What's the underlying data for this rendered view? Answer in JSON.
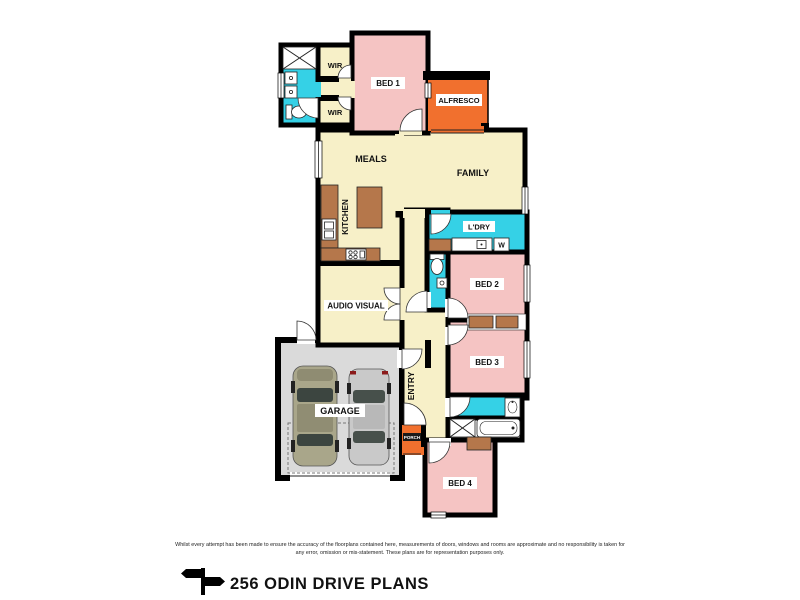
{
  "title": "256 ODIN DRIVE PLANS",
  "disclaimer": {
    "line1": "Whilst every attempt has been made to ensure the accuracy of the floorplans contained here, measurements of doors, windows and rooms are approximate and no responsibility is taken for",
    "line2": "any error, omission or mis-statement. These plans are for representation purposes only."
  },
  "rooms": {
    "bed1": "BED 1",
    "bed2": "BED 2",
    "bed3": "BED 3",
    "bed4": "BED 4",
    "wir1": "WIR",
    "wir2": "WIR",
    "alfresco": "ALFRESCO",
    "meals": "MEALS",
    "family": "FAMILY",
    "kitchen": "KITCHEN",
    "laundry": "L'DRY",
    "audio_visual": "AUDIO VISUAL",
    "entry": "ENTRY",
    "garage": "GARAGE",
    "porch": "PORCH"
  },
  "appliances": {
    "washer": "W"
  },
  "colors": {
    "floor_cream": "#F7F0C8",
    "bedroom_pink": "#F5C4C3",
    "wet_area_cyan": "#35D1E6",
    "outdoor_orange": "#F1702E",
    "bench_brown": "#B5774B",
    "garage_grey": "#DADADA",
    "wall_black": "#000000"
  }
}
